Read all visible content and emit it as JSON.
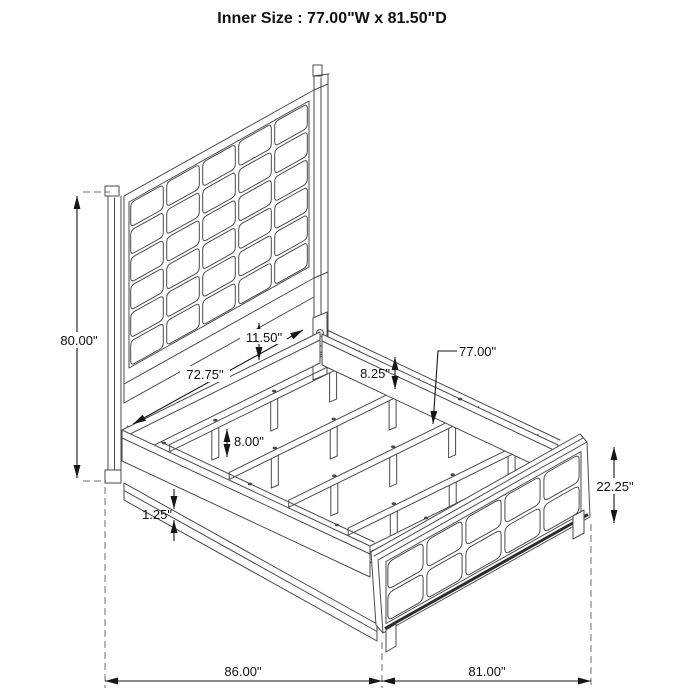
{
  "title": "Inner Size : 77.00\"W x 81.50\"D",
  "dimensions": {
    "headboard_height": "80.00\"",
    "slat_support_span": "72.75\"",
    "headboard_to_rail_gap": "11.50\"",
    "side_rail_height": "8.25\"",
    "slat_length": "77.00\"",
    "slat_leg_height": "8.00\"",
    "base_rail_lip": "1.25\"",
    "footboard_height": "22.25\"",
    "overall_length": "86.00\"",
    "overall_width": "81.00\""
  },
  "colors": {
    "line": "#4a4a4a",
    "dimension": "#161616",
    "extension": "#6e6e6e",
    "background": "#ffffff"
  }
}
